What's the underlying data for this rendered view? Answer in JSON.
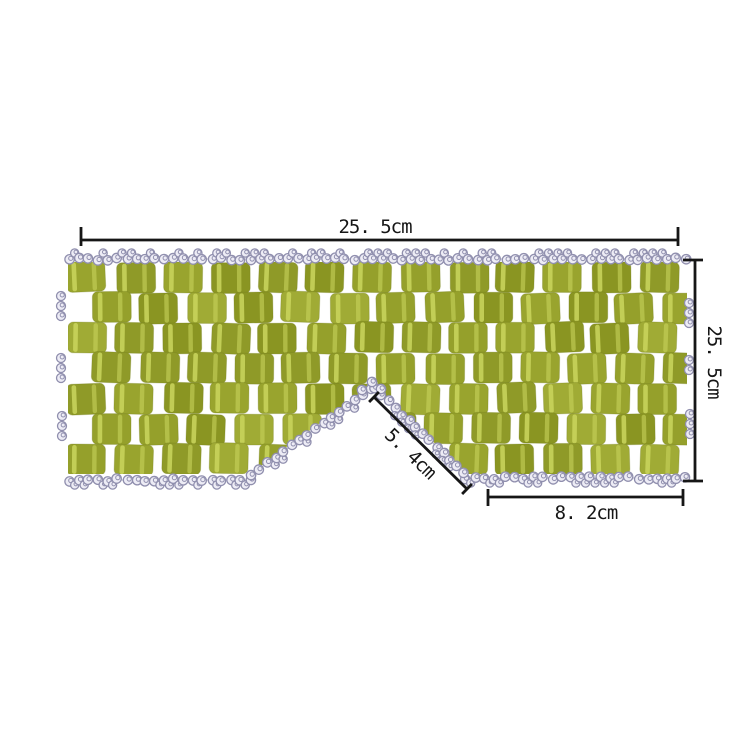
{
  "figure": {
    "annotations": {
      "top_width": "25. 5cm",
      "right_height": "25. 5cm",
      "nose_bridge": "5. 4cm",
      "bottom_right_width": "8. 2cm"
    },
    "colors": {
      "background": "#ffffff",
      "annotation": "#161616",
      "tile_palette": [
        "#99a42e",
        "#8f9a28",
        "#a0ab35",
        "#8a9522",
        "#95a02b"
      ],
      "tile_stripe": "#c8d45c",
      "tile_edge": "#6f7a1c",
      "bead_fill": "#edecf5",
      "bead_stroke": "#908fae",
      "thread": "#b4b2c9"
    }
  }
}
